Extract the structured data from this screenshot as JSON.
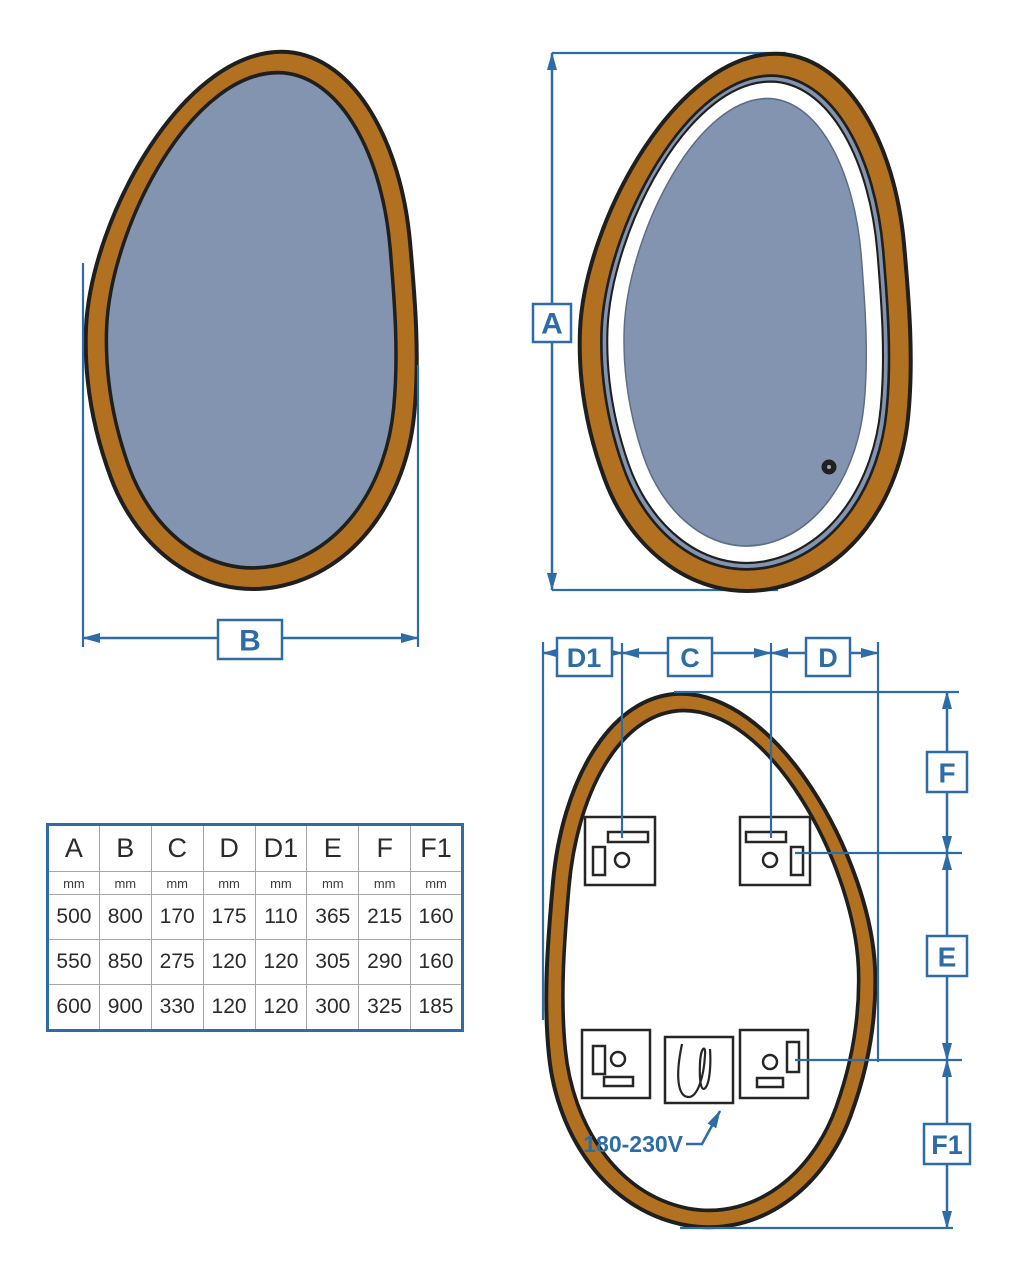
{
  "colors": {
    "dimension_blue": "#2d6ca6",
    "frame_brown": "#b17121",
    "glass_blue_gray": "#8294b0",
    "outline_dark": "#1f1f1d",
    "led_ring_white": "#ffffff"
  },
  "views": {
    "front": {
      "width_label": "B"
    },
    "illuminated": {
      "height_label": "A"
    },
    "back": {
      "left_offset_label": "D1",
      "bracket_spacing_label": "C",
      "right_offset_label": "D",
      "top_offset_label": "F",
      "vertical_spacing_label": "E",
      "bottom_offset_label": "F1",
      "voltage_label": "180-230V"
    }
  },
  "table": {
    "headers": [
      "A",
      "B",
      "C",
      "D",
      "D1",
      "E",
      "F",
      "F1"
    ],
    "units": [
      "mm",
      "mm",
      "mm",
      "mm",
      "mm",
      "mm",
      "mm",
      "mm"
    ],
    "rows": [
      [
        "500",
        "800",
        "170",
        "175",
        "110",
        "365",
        "215",
        "160"
      ],
      [
        "550",
        "850",
        "275",
        "120",
        "120",
        "305",
        "290",
        "160"
      ],
      [
        "600",
        "900",
        "330",
        "120",
        "120",
        "300",
        "325",
        "185"
      ]
    ]
  }
}
